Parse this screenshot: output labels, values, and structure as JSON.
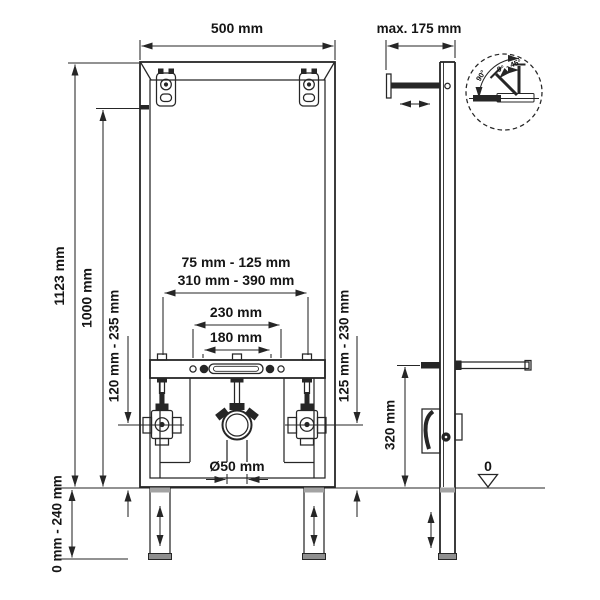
{
  "front_view": {
    "width": "500 mm",
    "total_height": "1123 mm",
    "upper_height": "1000 mm",
    "left_connection_range": "120 mm - 235 mm",
    "fixing_range_1": "75 mm - 125 mm",
    "fixing_range_2": "310 mm - 390 mm",
    "fixing_width_outer": "230 mm",
    "fixing_width_inner": "180 mm",
    "outlet_pipe_diameter": "Ø50 mm",
    "right_connection_range": "125 mm - 230 mm",
    "leg_adjustment_range": "0 mm - 240 mm"
  },
  "side_view": {
    "wall_distance": "max. 175 mm",
    "outlet_height": "320 mm",
    "floor_level": "0"
  },
  "angle_detail": {
    "angle_full": "90°",
    "angle_range": "0° - 45°"
  },
  "colors": {
    "line": "#262626",
    "background": "#ffffff"
  }
}
